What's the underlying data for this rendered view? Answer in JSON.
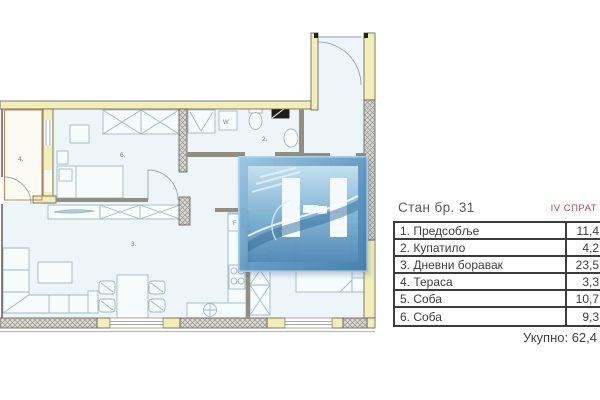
{
  "panel": {
    "title": "Стан бр. 31",
    "floor": "IV СПРАТ",
    "total": "Укупно: 62,4",
    "rows": [
      {
        "name": "1. Предсобље",
        "area": "11,4"
      },
      {
        "name": "2. Купатило",
        "area": "4,2"
      },
      {
        "name": "3. Дневни боравак",
        "area": "23,5"
      },
      {
        "name": "4. Тераса",
        "area": "3,3"
      },
      {
        "name": "5. Соба",
        "area": "10,7"
      },
      {
        "name": "6. Соба",
        "area": "9,3"
      }
    ]
  },
  "plan": {
    "room_labels": {
      "terrace": "4.",
      "bedroom_top": "6.",
      "living_room": "3.",
      "bathroom": "2."
    },
    "fixture_labels": {
      "washing_machine": "W",
      "fridge": "F"
    }
  },
  "colors": {
    "wall_yellow": "#f2eeb9",
    "floor_accent_red": "#b04a4a",
    "logo_blue": "#4d86b2",
    "room_fill": "#edf5f8"
  }
}
